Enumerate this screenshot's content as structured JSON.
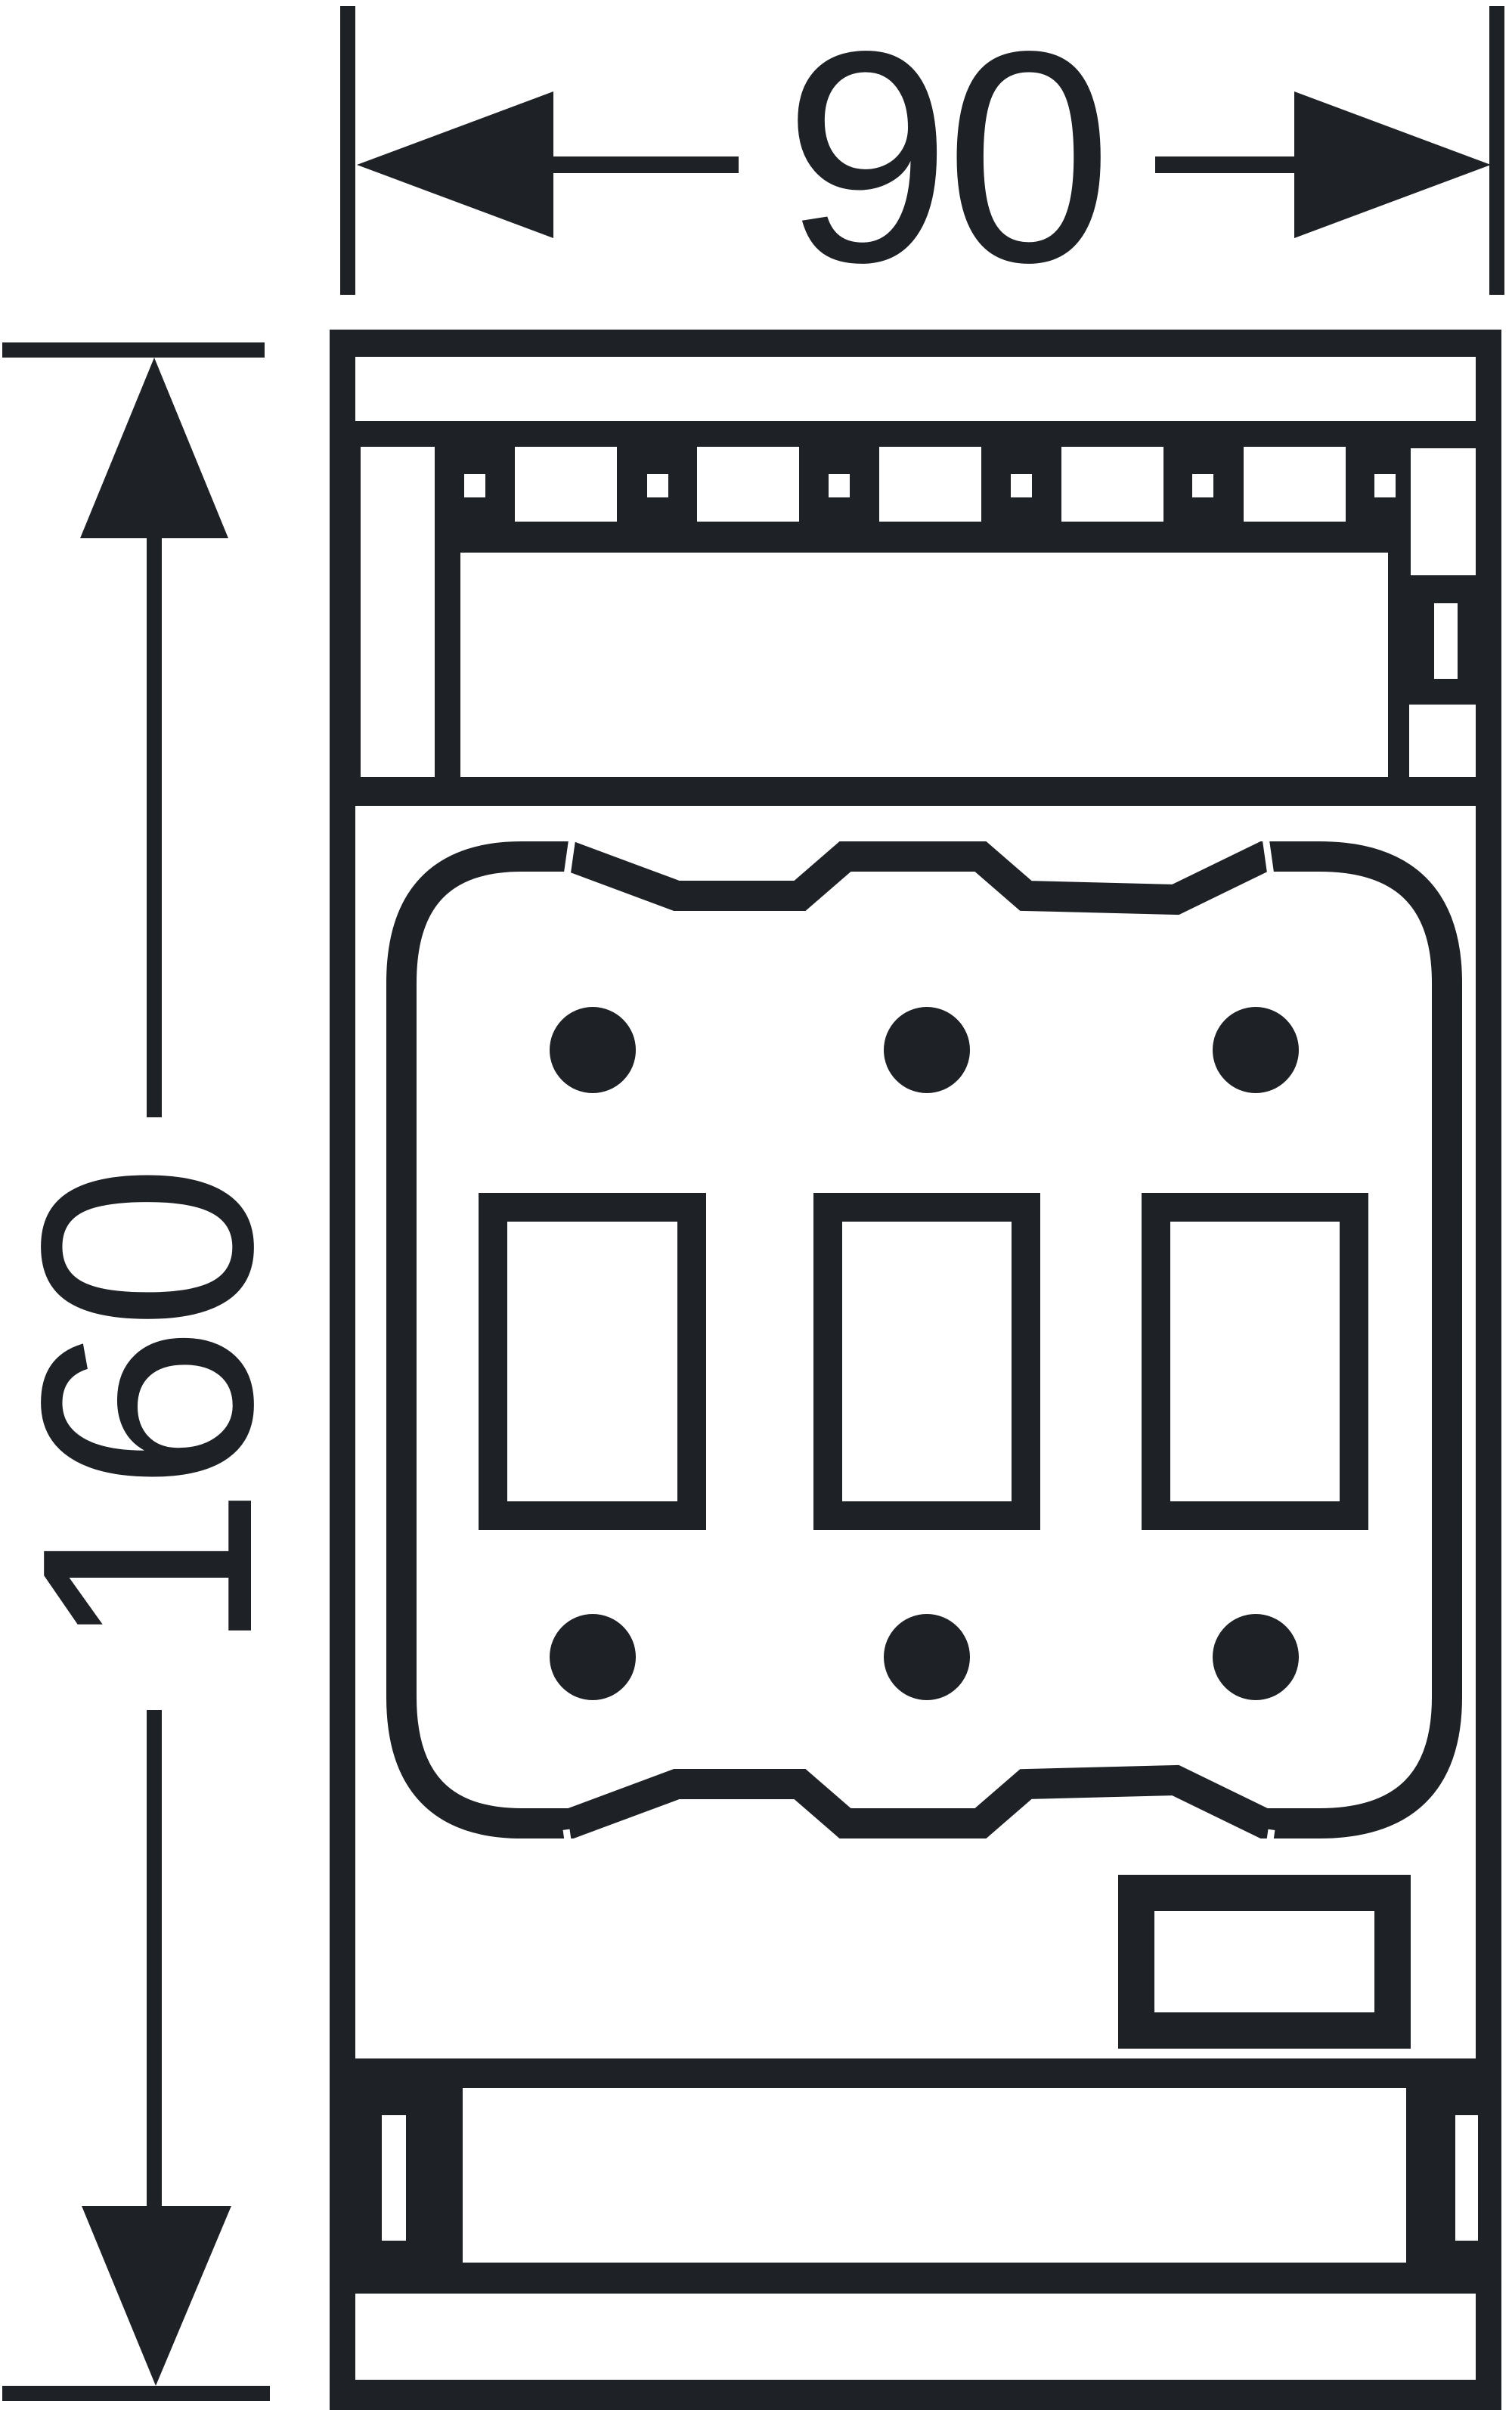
{
  "page": {
    "background": "#ffffff",
    "kind": "technical dimension drawing"
  },
  "colors": {
    "ink": "#1e2126",
    "background": "#ffffff"
  },
  "dimensions": {
    "width": {
      "label": "90"
    },
    "height": {
      "label": "160"
    }
  },
  "icons": {
    "arrowhead_left": "filled triangle pointing left",
    "arrowhead_right": "filled triangle pointing right",
    "arrowhead_up": "filled triangle pointing up",
    "arrowhead_down": "filled triangle pointing down"
  }
}
